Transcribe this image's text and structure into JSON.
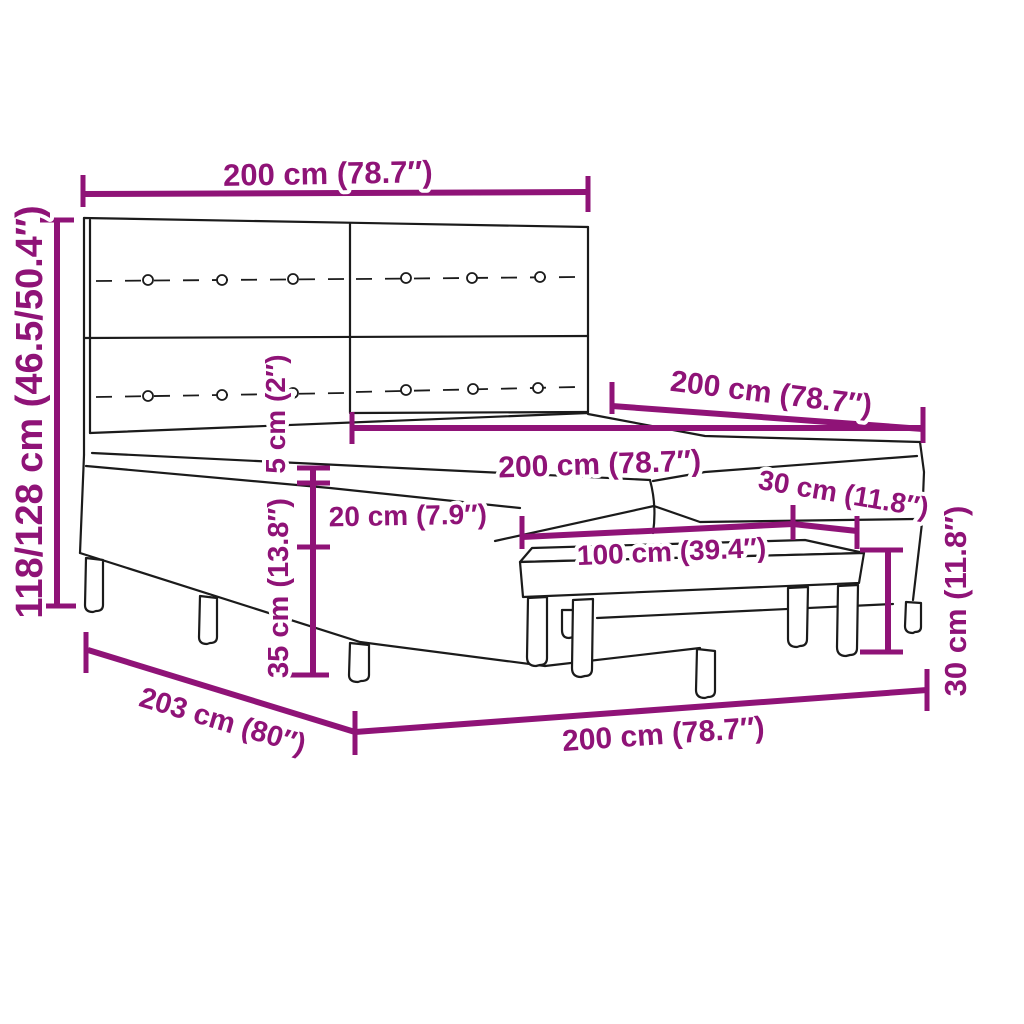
{
  "diagram": {
    "description": "Dimension diagram of an upholstered box spring bed with panel headboard and matching bench",
    "colors": {
      "dimension_line": "#8F1377",
      "outline": "#1b1b1b",
      "background": "#ffffff"
    },
    "labels": {
      "headboard_width": "200 cm (78.7″)",
      "overall_height": "118/128 cm (46.5/50.4″)",
      "bed_length": "200 cm (78.7″)",
      "mattress_width": "200 cm (78.7″)",
      "mattress_thickness": "5 cm (2″)",
      "base_height": "20 cm (7.9″)",
      "leg_height": "35 cm (13.8″)",
      "bench_length": "100 cm (39.4″)",
      "bench_depth": "30 cm (11.8″)",
      "bench_height": "30 cm (11.8″)",
      "base_length": "200 cm (78.7″)",
      "base_width": "203 cm (80″)"
    }
  }
}
